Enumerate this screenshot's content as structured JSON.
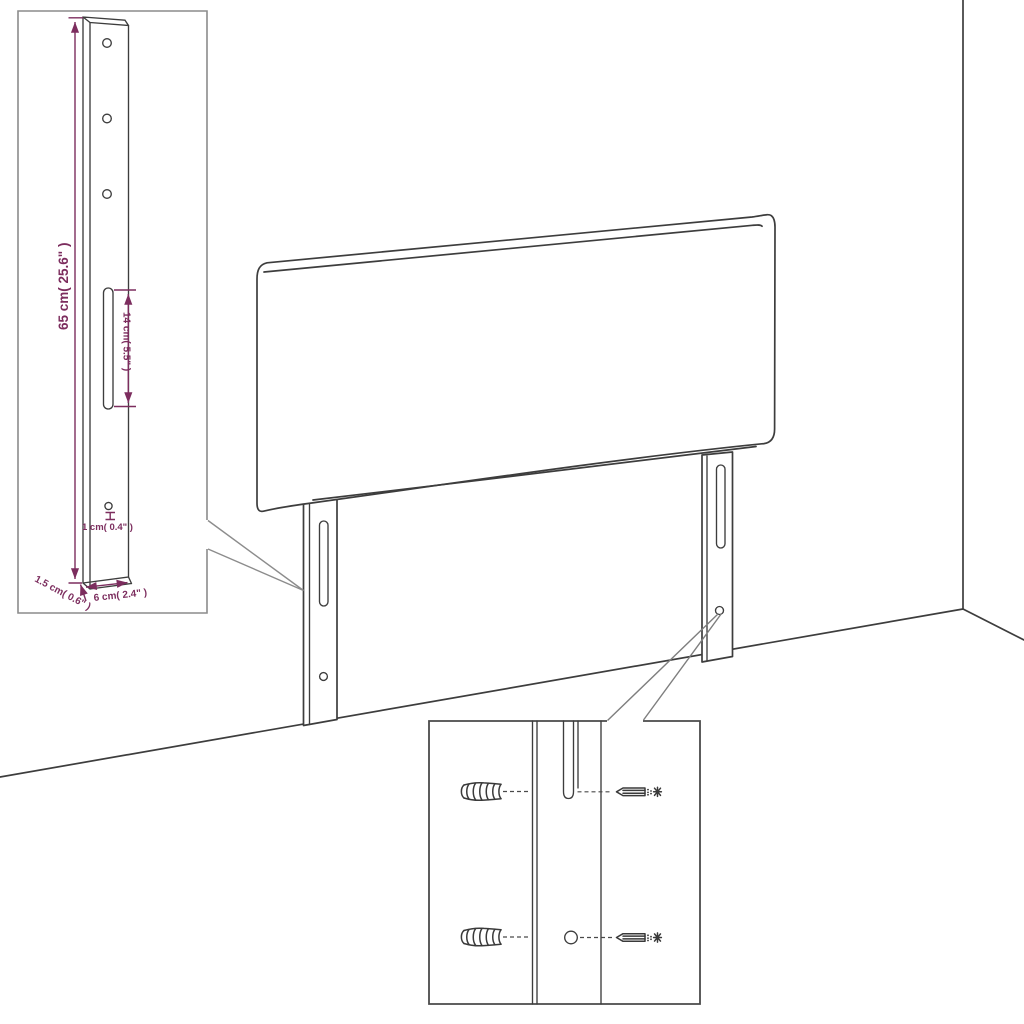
{
  "title": "Headboard with legs - assembly dimension diagram",
  "colors": {
    "background": "#ffffff",
    "outline": "#3d3d3d",
    "dimension_text": "#7c2d5e",
    "callout_line": "#8c8c8c",
    "leg_inset_border": "#8c8c8c",
    "mount_inset_border": "#4a4a4a"
  },
  "leg_detail_inset": {
    "dim_height": "65 cm( 25.6\" )",
    "dim_slot_length": "14 cm( 5.5\" )",
    "dim_hole_diameter": "1 cm( 0.4\" )",
    "dim_leg_thickness": "1.5 cm( 0.6\" )",
    "dim_leg_width": "6 cm( 2.4\" )"
  },
  "mounting_detail_inset": {
    "hardware": [
      "wall-anchor",
      "wall-anchor",
      "screw",
      "screw"
    ]
  }
}
